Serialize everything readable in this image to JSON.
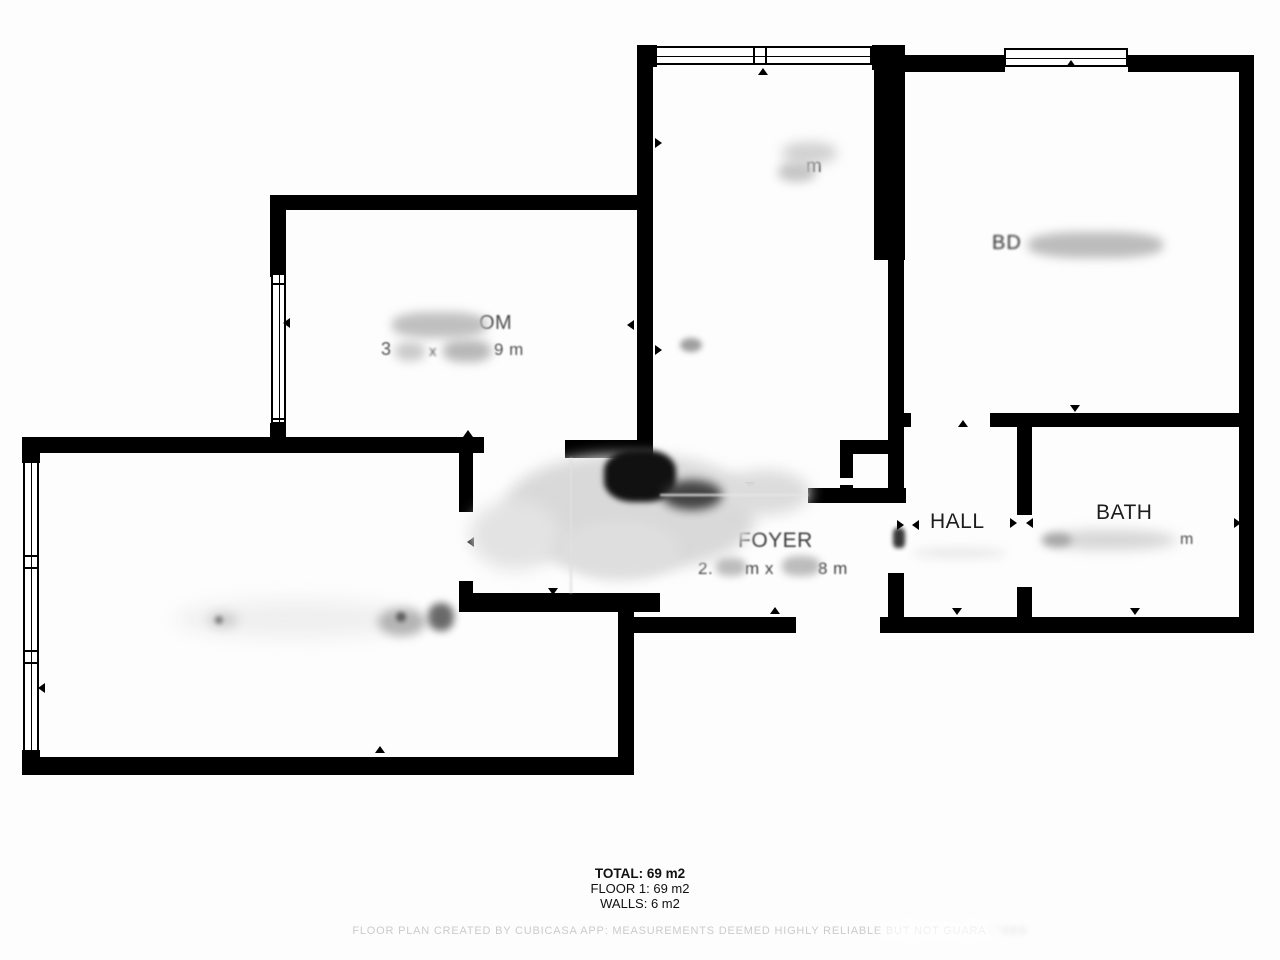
{
  "plan": {
    "rooms": {
      "top_middle": {
        "dims_fragment": "m"
      },
      "top_right": {
        "name_fragment": "BD"
      },
      "left_bedroom": {
        "name_fragment": "OM",
        "dim_1": "3",
        "dim_x": "x",
        "dim_2": "9 m"
      },
      "foyer": {
        "name": "FOYER",
        "dim_1": "2.",
        "dim_mid": "m x",
        "dim_2": "8 m"
      },
      "hall": {
        "name": "HALL"
      },
      "bath": {
        "name": "BATH",
        "dims_fragment": "m"
      }
    },
    "summary": {
      "total": "TOTAL: 69 m2",
      "floor1": "FLOOR 1: 69 m2",
      "walls": "WALLS: 6 m2"
    },
    "footer": {
      "main": "FLOOR PLAN CREATED BY CUBICASA APP: MEASUREMENTS DEEMED HIGHLY RELIABLE BUT NOT GUARA",
      "tail": "NTEED"
    }
  }
}
